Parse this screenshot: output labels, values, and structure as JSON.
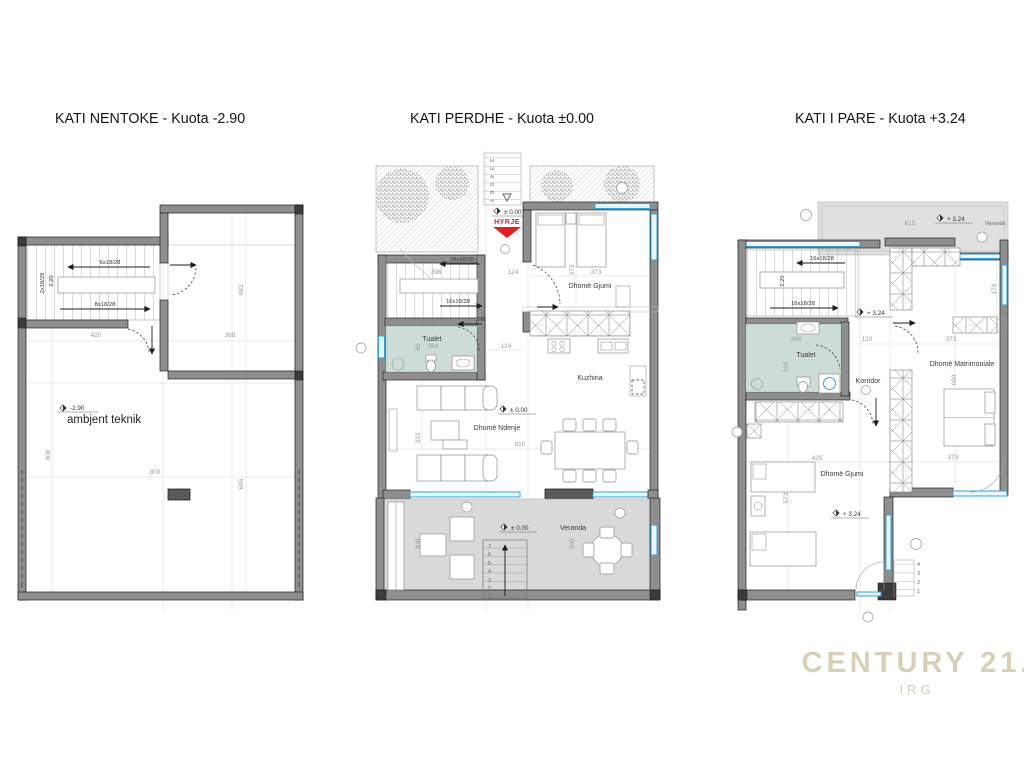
{
  "titles": {
    "plan1": "KATI NENTOKE - Kuota -2.90",
    "plan2": "KATI PERDHE - Kuota ±0.00",
    "plan3": "KATI I PARE - Kuota +3.24"
  },
  "plan1": {
    "stair_run_up": "6x18/28",
    "stair_run_down": "8x18/28",
    "stair_flight": "2x18/28",
    "stair_height": "2.20",
    "level": "-2.90",
    "room_technical": "ambjent teknik",
    "dims": {
      "w420": "420",
      "w368": "368",
      "h483": "483",
      "h808": "808",
      "w800": "800",
      "h645": "645"
    }
  },
  "plan2": {
    "entry_label": "HYRJE",
    "level": "± 0.00",
    "stair_run_a": "16x18/28",
    "stair_run_b": "16x18/28",
    "entry_steps": [
      "2",
      "3",
      "4",
      "5",
      "6",
      "7"
    ],
    "veranda_steps": [
      "7",
      "6",
      "5",
      "4",
      "3",
      "2",
      "1"
    ],
    "rooms": {
      "bedroom": "Dhomë Gjumi",
      "toilet": "Tualet",
      "kitchen": "Kuzhina",
      "living": "Dhomë Ndenje",
      "veranda": "Veranda"
    },
    "dims": {
      "w296": "296",
      "w284": "284",
      "w124a": "124",
      "w124b": "124",
      "h60": "60",
      "w373": "373",
      "h373": "373",
      "h333": "333",
      "w810": "810",
      "h300a": "300",
      "h300b": "300"
    }
  },
  "plan3": {
    "level": "+ 3.24",
    "stair_run_a": "16x18/28",
    "stair_run_b": "16x18/28",
    "stair_height": "2.20",
    "exterior_steps": [
      "4",
      "3",
      "2",
      "1"
    ],
    "rooms": {
      "toilet": "Tualet",
      "corridor": "Korridor",
      "master": "Dhomë Matrimoniale",
      "bedroom": "Dhomë Gjumi",
      "veranda": "Veranda"
    },
    "dims": {
      "w615": "615",
      "w288": "288",
      "w120": "120",
      "w373a": "373",
      "h178": "178",
      "h220": "220",
      "w425": "425",
      "h573": "573",
      "h690": "690",
      "w373b": "373"
    }
  },
  "watermark": {
    "brand": "CENTURY 21.",
    "sub": "IRG"
  }
}
